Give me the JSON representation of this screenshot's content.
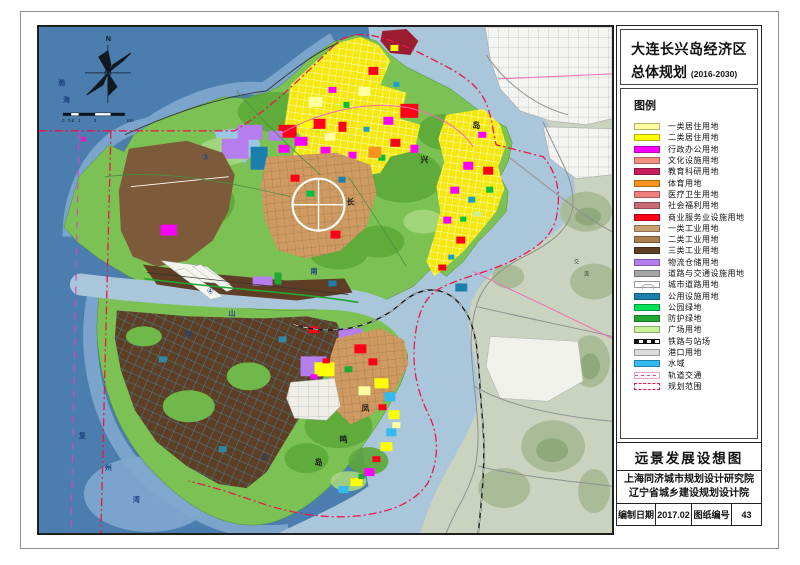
{
  "panel": {
    "title": {
      "line1": "大连长兴岛经济区",
      "line2": "总体规划",
      "subtitle": "(2016-2030)"
    },
    "legend": {
      "title": "图例",
      "items": [
        {
          "label": "一类居住用地",
          "color": "#FFFFA0"
        },
        {
          "label": "二类居住用地",
          "color": "#FFFF00"
        },
        {
          "label": "行政办公用地",
          "color": "#FF00FF"
        },
        {
          "label": "文化设施用地",
          "color": "#F49080"
        },
        {
          "label": "教育科研用地",
          "color": "#C81E5A"
        },
        {
          "label": "体育用地",
          "color": "#F7941D"
        },
        {
          "label": "医疗卫生用地",
          "color": "#F08080"
        },
        {
          "label": "社会福利用地",
          "color": "#C96B76"
        },
        {
          "label": "商业服务业设施用地",
          "color": "#FF0018"
        },
        {
          "label": "一类工业用地",
          "color": "#C9A171"
        },
        {
          "label": "二类工业用地",
          "color": "#AE7F4E"
        },
        {
          "label": "三类工业用地",
          "color": "#5E3E24"
        },
        {
          "label": "物流仓储用地",
          "color": "#B57DEE"
        },
        {
          "label": "道路与交通设施用地",
          "color": "#A6A6A6"
        },
        {
          "label": "城市道路用地",
          "type": "road"
        },
        {
          "label": "公用设施用地",
          "color": "#1B7FAE"
        },
        {
          "label": "公园绿地",
          "color": "#00E05A"
        },
        {
          "label": "防护绿地",
          "color": "#1FA832"
        },
        {
          "label": "广场用地",
          "color": "#C9F39B"
        },
        {
          "label": "铁路与站场",
          "type": "rail"
        },
        {
          "label": "港口用地",
          "color": "#DCDCDA"
        },
        {
          "label": "水域",
          "color": "#33BBEE"
        },
        {
          "label": "轨道交通",
          "type": "transit"
        },
        {
          "label": "规划范围",
          "type": "boundary"
        }
      ]
    },
    "concept_title": "远景发展设想图",
    "institutes": [
      "上海同济城市规划设计研究院",
      "辽宁省城乡建设规划设计院"
    ],
    "meta": {
      "date_label": "编制日期",
      "date_value": "2017.02",
      "sheet_no_label": "图纸编号",
      "sheet_no_value": "43"
    }
  },
  "map": {
    "palette": {
      "deep_sea": "#4B7DAF",
      "shallow": "#7FA9CE",
      "strait": "#A9C6DB",
      "island_green": "#7CC154",
      "hill_dark": "#5CA93A",
      "mainland": "#CAD2C0",
      "boundary_red": "#E8184A",
      "transit_pink": "#E040C8"
    },
    "labels": [
      {
        "t": "渤",
        "x": 19,
        "y": 58,
        "cls": "sea"
      },
      {
        "t": "海",
        "x": 24,
        "y": 75,
        "cls": "sea"
      },
      {
        "t": "复",
        "x": 40,
        "y": 412,
        "cls": "sea"
      },
      {
        "t": "州",
        "x": 66,
        "y": 444,
        "cls": "sea"
      },
      {
        "t": "湾",
        "x": 94,
        "y": 476,
        "cls": "sea"
      },
      {
        "t": "南",
        "x": 272,
        "y": 247,
        "cls": "sea"
      },
      {
        "t": "山",
        "x": 190,
        "y": 289,
        "cls": "sea"
      },
      {
        "t": "河",
        "x": 146,
        "y": 310,
        "cls": "sea"
      },
      {
        "t": "长",
        "x": 308,
        "y": 178,
        "cls": "land"
      },
      {
        "t": "兴",
        "x": 382,
        "y": 136,
        "cls": "land"
      },
      {
        "t": "岛",
        "x": 434,
        "y": 101,
        "cls": "land"
      },
      {
        "t": "凤",
        "x": 323,
        "y": 385,
        "cls": "land"
      },
      {
        "t": "鸣",
        "x": 301,
        "y": 416,
        "cls": "land"
      },
      {
        "t": "岛",
        "x": 276,
        "y": 439,
        "cls": "land"
      },
      {
        "t": "交",
        "x": 536,
        "y": 237,
        "cls": "tiny"
      },
      {
        "t": "流",
        "x": 546,
        "y": 249,
        "cls": "tiny"
      },
      {
        "t": "③",
        "x": 163,
        "y": 133,
        "cls": "marker"
      },
      {
        "t": "④",
        "x": 168,
        "y": 267,
        "cls": "marker"
      },
      {
        "t": "②",
        "x": 222,
        "y": 434,
        "cls": "marker"
      },
      {
        "t": "N",
        "x": 67,
        "y": 14,
        "cls": "compass"
      },
      {
        "t": "0",
        "x": 23,
        "y": 95,
        "cls": "scale"
      },
      {
        "t": "0.5",
        "x": 29,
        "y": 95,
        "cls": "scale"
      },
      {
        "t": "1",
        "x": 39,
        "y": 95,
        "cls": "scale"
      },
      {
        "t": "2",
        "x": 55,
        "y": 95,
        "cls": "scale"
      },
      {
        "t": "Km",
        "x": 88,
        "y": 95,
        "cls": "scale"
      }
    ]
  }
}
